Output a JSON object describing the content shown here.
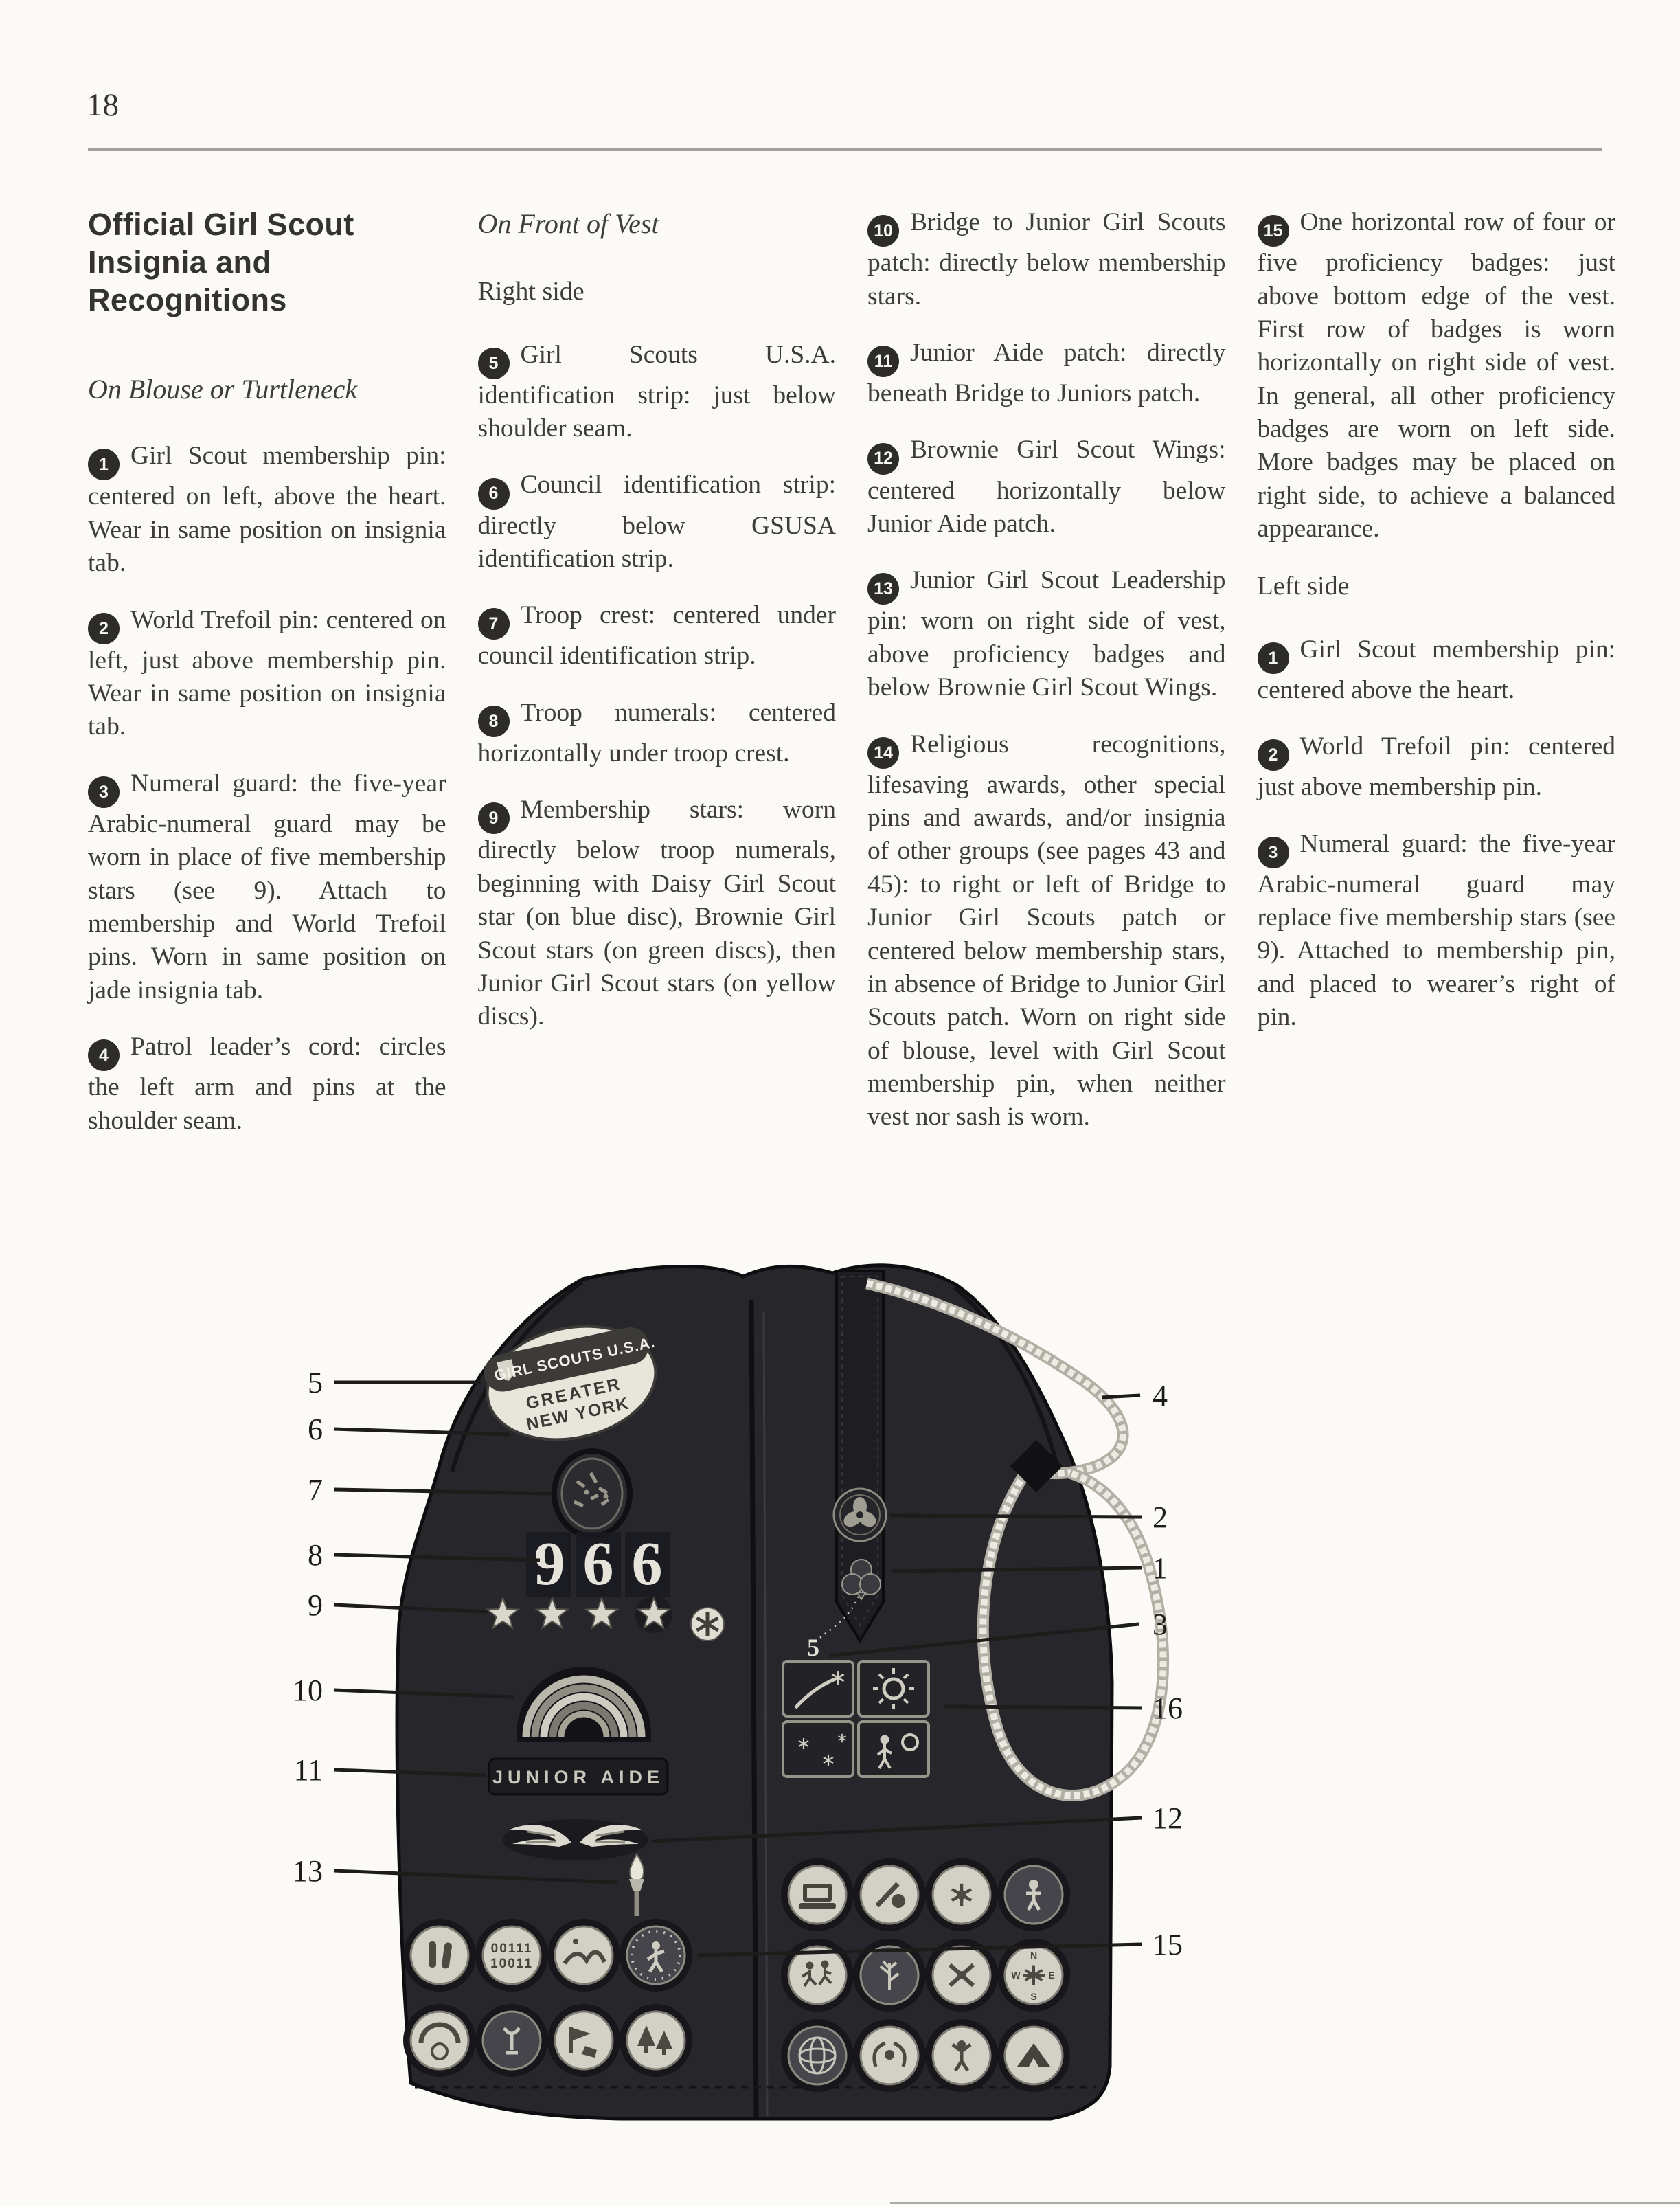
{
  "page": {
    "number": "18"
  },
  "col1": {
    "heading": "Official Girl Scout Insignia and Recognitions",
    "subhead": "On Blouse or Turtleneck",
    "items": [
      {
        "num": "1",
        "text": "Girl Scout membership pin: centered on left, above the heart. Wear in same position on insignia tab."
      },
      {
        "num": "2",
        "text": "World Trefoil pin: centered on left, just above membership pin. Wear in same position on insignia tab."
      },
      {
        "num": "3",
        "text": "Numeral guard: the five-year Arabic-numeral guard may be worn in place of five membership stars (see 9). Attach to membership and World Trefoil pins. Worn in same position on jade insignia tab."
      },
      {
        "num": "4",
        "text": "Patrol leader’s cord: circles the left arm and pins at the shoulder seam."
      }
    ]
  },
  "col2": {
    "subhead": "On Front of Vest",
    "side_label": "Right side",
    "items": [
      {
        "num": "5",
        "text": "Girl Scouts U.S.A. identification strip: just below shoulder seam."
      },
      {
        "num": "6",
        "text": "Council identification strip: directly below GSUSA identification strip."
      },
      {
        "num": "7",
        "text": "Troop crest: centered under council identification strip."
      },
      {
        "num": "8",
        "text": "Troop numerals: centered horizontally under troop crest."
      },
      {
        "num": "9",
        "text": "Membership stars: worn directly below troop numerals, beginning with Daisy Girl Scout star (on blue disc), Brownie Girl Scout stars (on green discs), then Junior Girl Scout stars (on yellow discs)."
      }
    ]
  },
  "col3": {
    "items": [
      {
        "num": "10",
        "text": "Bridge to Junior Girl Scouts patch: directly below membership stars."
      },
      {
        "num": "11",
        "text": "Junior Aide patch: directly beneath Bridge to Juniors patch."
      },
      {
        "num": "12",
        "text": "Brownie Girl Scout Wings: centered horizontally below Junior Aide patch."
      },
      {
        "num": "13",
        "text": "Junior Girl Scout Leadership pin: worn on right side of vest, above proficiency badges and below Brownie Girl Scout Wings."
      },
      {
        "num": "14",
        "text": "Religious recognitions, lifesaving awards, other special pins and awards, and/or insignia of other groups (see pages 43 and 45): to right or left of Bridge to Junior Girl Scouts patch or centered below membership stars, in absence of Bridge to Junior Girl Scouts patch. Worn on right side of blouse, level with Girl Scout membership pin, when neither vest nor sash is worn."
      }
    ]
  },
  "col4": {
    "item15": {
      "num": "15",
      "text": "One horizontal row of four or five proficiency badges: just above bottom edge of the vest. First row of badges is worn horizontally on right side of vest. In general, all other proficiency badges are worn on left side. More badges may be placed on right side, to achieve a balanced appearance."
    },
    "side_label": "Left side",
    "items": [
      {
        "num": "1",
        "text": "Girl Scout membership pin: centered above the heart."
      },
      {
        "num": "2",
        "text": "World Trefoil pin: centered just above membership pin."
      },
      {
        "num": "3",
        "text": "Numeral guard: the five-year Arabic-numeral guard may replace five membership stars (see 9). Attached to membership pin, and placed to wearer’s right of pin."
      }
    ]
  },
  "figure": {
    "patches": {
      "gsusa_strip": "GIRL SCOUTS U.S.A.",
      "council_strip_line1": "GREATER",
      "council_strip_line2": "NEW YORK",
      "troop_numerals": "966",
      "junior_aide": "JUNIOR AIDE",
      "numeral_guard": "5",
      "binary_badge_line1": "00111",
      "binary_badge_line2": "10011",
      "compass_n": "N",
      "compass_e": "E",
      "compass_s": "S",
      "compass_w": "W"
    },
    "callouts_left": [
      "5",
      "6",
      "7",
      "8",
      "9",
      "10",
      "11",
      "13"
    ],
    "callouts_right": [
      "4",
      "2",
      "1",
      "3",
      "16",
      "12",
      "15"
    ]
  }
}
